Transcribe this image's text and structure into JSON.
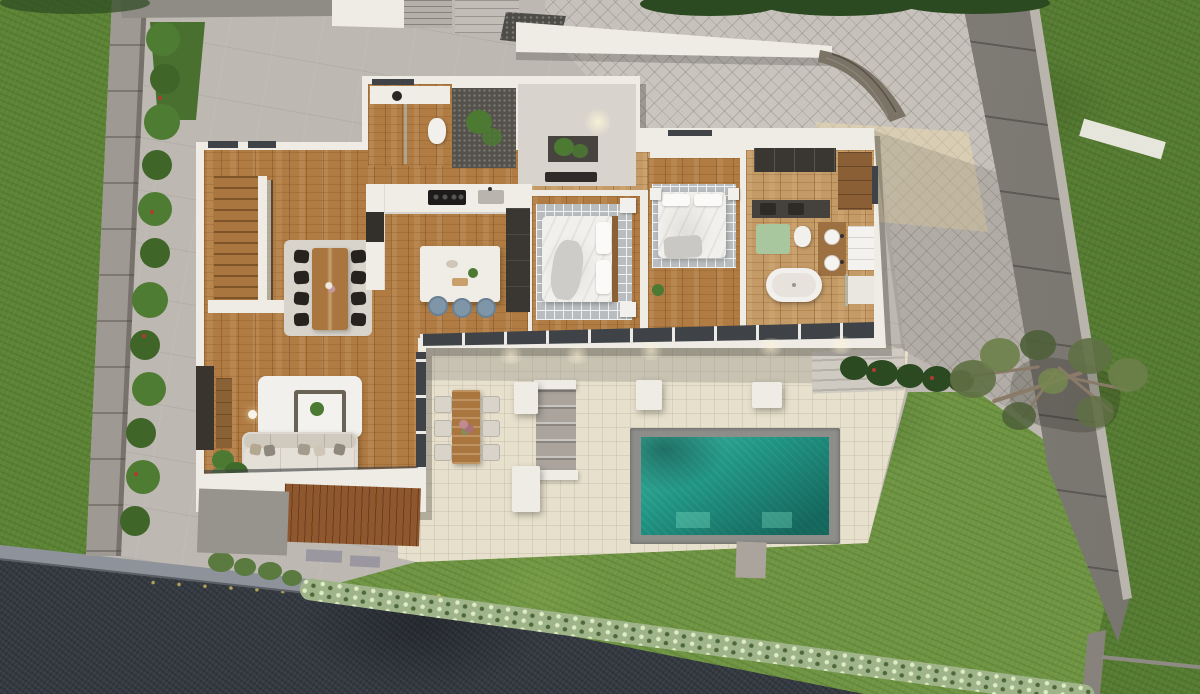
{
  "meta": {
    "description": "Top-down aerial 3D architectural render of a modern single-storey villa with open roof view, garden, driveway, terrace and rectangular swimming pool",
    "width_px": 1200,
    "height_px": 694,
    "time_of_day": "dusk with warm interior downlights"
  },
  "palette": {
    "concrete_ground": "#bdb8b1",
    "paver_gray": "#c6c1ba",
    "paver_sunlit": "#ecd9ae",
    "lawn_left": "#5c8336",
    "grass_right": "#567b33",
    "grass_bottom": "#6f9544",
    "grass_shade": "#4a7030",
    "asphalt": "#363b43",
    "curb": "#8e939b",
    "boundary_wall": "#87837c",
    "boundary_wall_edge": "#b9b5ad",
    "wall_concrete": "#9e9992",
    "white_wall": "#efece6",
    "roof_slab": "#8f8b85",
    "gravel": "#4e4c47",
    "stone_wall": "#7b7365",
    "hedge_dark": "#2c4a21",
    "bush_green": "#4f7c33",
    "bush_green_dark": "#3f6628",
    "hedge_light": "#9fb489",
    "shrub_green": "#5a7a40",
    "flower_red": "#b23a2e",
    "deck_beige": "#e7e0cc",
    "deck_gray": "#b7b2aa",
    "step_gray": "#aaa49d",
    "pool_rim": "#8d8d8a",
    "pool_water": "#1f9483",
    "wood_floor": "#b07c44",
    "wood_light": "#c49a66",
    "wood_furniture": "#a9763f",
    "deck_wood": "#8f572e",
    "rug_gray": "#b9bdbf",
    "rug_light": "#d8d4cb",
    "white_soft": "#f2f0ec",
    "sofa": "#ddd8cf",
    "tv_panel": "#39342e",
    "dark_unit": "#3a3631",
    "island_white": "#f0ede7",
    "stool_blue": "#7f96a8",
    "chair_black": "#26231f",
    "chair_outdoor": "#d9d4ca",
    "bath_mat": "#a9c79e",
    "vanity_dark": "#45423d",
    "glass_dark": "#3f4347",
    "tree_foliage": "#5f7044",
    "tree_branch": "#8a7a68",
    "entry_floor": "#d8d4cd",
    "pebble_dark": "#55524c",
    "plant_green": "#4c7a33"
  },
  "scene": {
    "site": {
      "driveway_paving": "herringbone pavers",
      "street": "dark asphalt, lower left",
      "boundary_walls": 2,
      "left_wall_bush_count": 12,
      "pool": {
        "shape": "rectangular",
        "water": "teal gradient",
        "rim": "gray stone",
        "underwater_benches": 2
      },
      "tree": "olive tree overhanging right boundary wall",
      "hedges": [
        "dark hedge along top edge",
        "flowering hedge along street edge",
        "dark shrub row east of terrace"
      ]
    },
    "house": {
      "rooms": [
        {
          "name": "living-room",
          "furniture": [
            "sofa with 5 pillows",
            "tv-wall",
            "fire-table on white rug",
            "floor-plant",
            "floor-lamp",
            "timber deck"
          ]
        },
        {
          "name": "dining-area",
          "furniture": [
            "wood table",
            "8 black chairs",
            "light rug"
          ]
        },
        {
          "name": "kitchen",
          "furniture": [
            "white island",
            "3 blue bar stools",
            "cooktop",
            "sink",
            "dark pantry column"
          ]
        },
        {
          "name": "staircase",
          "furniture": [
            "timber treads",
            "white stringer",
            "glass balustrade"
          ]
        },
        {
          "name": "entry-hall",
          "furniture": [
            "planting bed",
            "black console bench"
          ]
        },
        {
          "name": "powder-room",
          "furniture": [
            "vanity with round basin",
            "toilet",
            "shower"
          ]
        },
        {
          "name": "courtyard-lightwell",
          "furniture": [
            "pebbles",
            "green plant"
          ]
        },
        {
          "name": "bedroom-1",
          "furniture": [
            "double bed",
            "2 nightstands",
            "gray grid rug"
          ]
        },
        {
          "name": "bedroom-2",
          "furniture": [
            "double bed",
            "2 nightstands",
            "gray grid rug",
            "plant"
          ]
        },
        {
          "name": "bathroom",
          "furniture": [
            "freestanding tub",
            "twin round sinks on timber vanity",
            "toilet",
            "shower",
            "dark wardrobe",
            "green bath mat",
            "towel shelves"
          ]
        }
      ]
    },
    "terrace": {
      "items": [
        "outdoor dining table with 6 chairs",
        "concrete steps",
        "4 white planter benches",
        "steps up to lawn"
      ],
      "floor": "beige stone tiles with gray walkway band"
    }
  }
}
